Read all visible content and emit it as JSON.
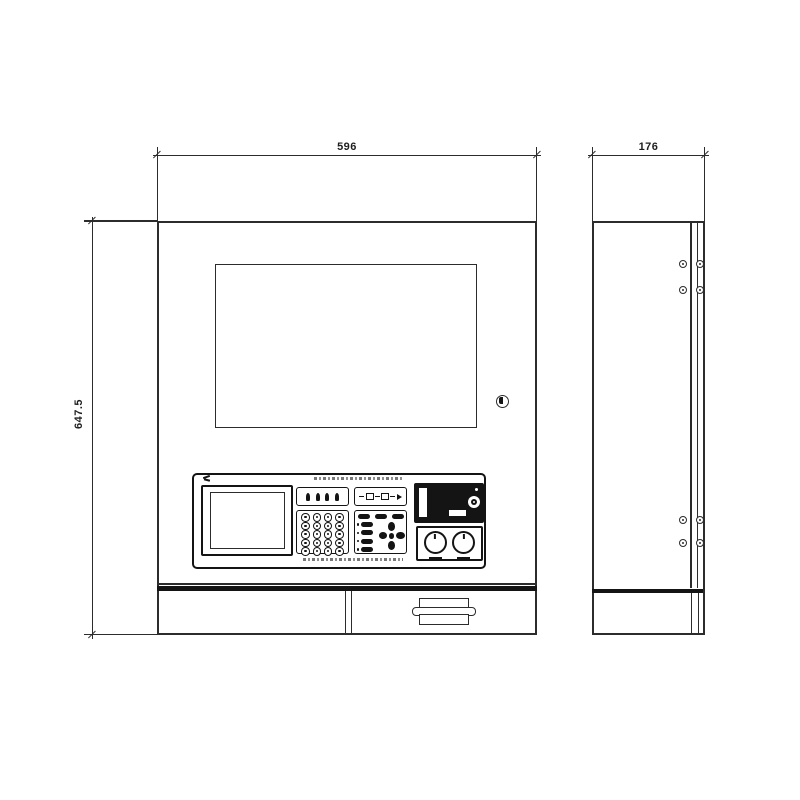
{
  "drawing": {
    "kind": "technical elevation drawing, front and side views of a wall-mounted control cabinet",
    "dimensions": {
      "front_width_label": "596",
      "side_depth_label": "176",
      "front_height_label": "647.5"
    },
    "colors": {
      "line": "#2c2c2c",
      "dark_fill": "#141414",
      "background": "#ffffff"
    },
    "front_view": {
      "features": [
        "display-screen",
        "door-lock",
        "operator-console",
        "bottom-compartment",
        "label-holder-handle"
      ],
      "console": {
        "keypad": {
          "rows": 5,
          "cols": 4
        },
        "indicator_icon_count": 4,
        "top_pill_count": 3,
        "function_pill_count": 4,
        "dpad_directions": [
          "up",
          "right",
          "down",
          "left"
        ],
        "knob_count": 2
      }
    },
    "side_view": {
      "features": [
        "hinge-screw-pairs",
        "door-edge-lines",
        "bottom-compartment"
      ],
      "screw_pair_rows": 4,
      "screws_per_row": 2
    }
  }
}
